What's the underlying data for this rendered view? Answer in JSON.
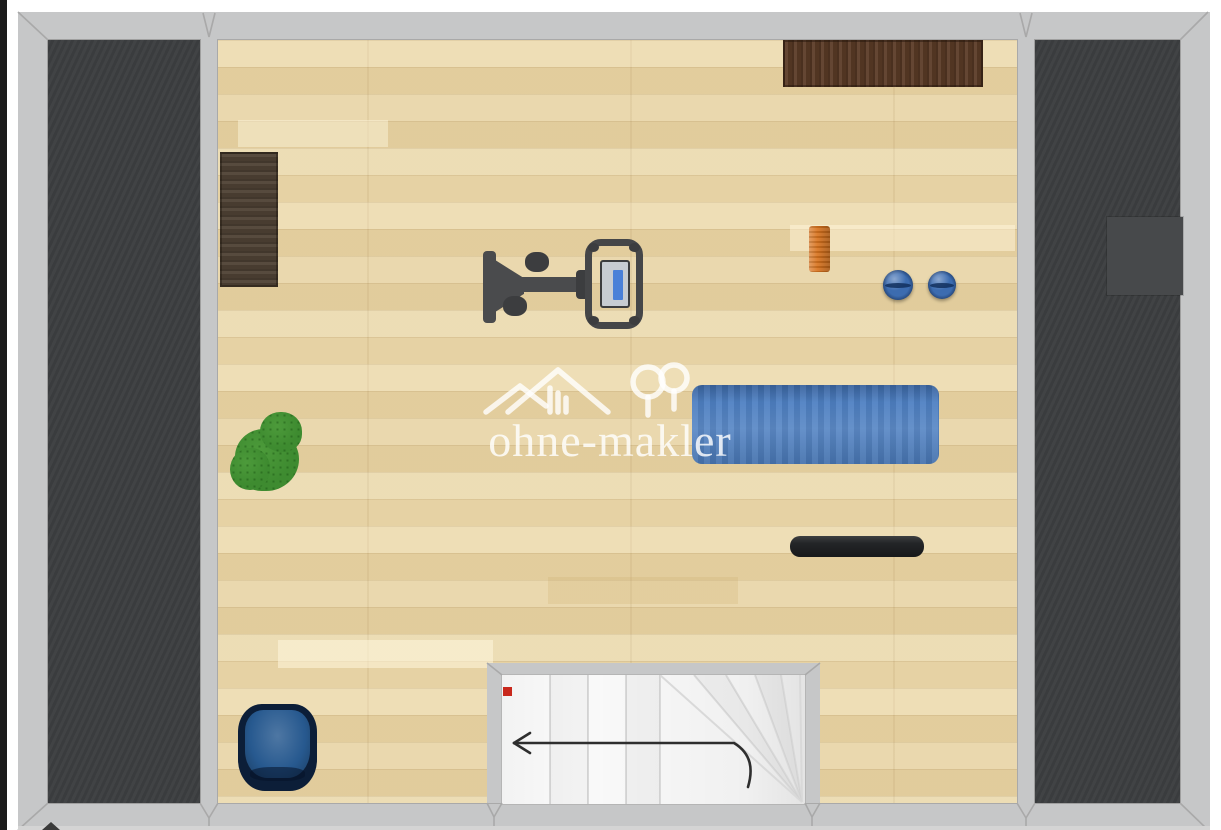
{
  "scene": {
    "type": "floor-plan-top-view",
    "description": "Attic fitness room floor plan with staircase, exercise equipment and side storage areas",
    "floor_material": "light oak parquet"
  },
  "watermark": {
    "text": "ohne-makler",
    "logo": "house-and-trees-icon",
    "color": "rgba(255,255,255,0.82)"
  },
  "palette": {
    "page_edge": "#1b1b1b",
    "wall": "#c6c7c8",
    "wall_seam": "#a9a9a9",
    "dark_area": "#3d3f41",
    "skylight": "#47494b",
    "floor_base": "#e8d6aa",
    "plank_light": "rgba(255,246,220,0.55)",
    "stair_bg": "#fafafa",
    "tread_line": "#d9d9d9",
    "arrow": "#2e2e2e",
    "red_marker": "#c8281c",
    "sideboard_brown": "#5a3b26",
    "desk_brown": "#4e4134",
    "equipment_gray": "#4a4b4d",
    "equipment_dark": "#3c3d3f",
    "console_body": "#c7ccd2",
    "console_screen": "#4a80d8",
    "roller_orange": "#d8731e",
    "ball_blue": "#3c6cb0",
    "mat_blue": "#4e80c2",
    "bar_black": "#232527",
    "plant_green": "#3e8b30",
    "chair_outer": "#0c1e38",
    "chair_inner": "#27598f"
  },
  "objects": [
    {
      "name": "sideboard-top-wall",
      "color": "#5a3b26"
    },
    {
      "name": "desk-left-wall",
      "color": "#4e4134"
    },
    {
      "name": "elliptical-trainer",
      "color": "#4a4b4d"
    },
    {
      "name": "foam-roller",
      "color": "#d8731e"
    },
    {
      "name": "medicine-ball-left",
      "color": "#3c6cb0"
    },
    {
      "name": "medicine-ball-right",
      "color": "#3c6cb0"
    },
    {
      "name": "yoga-mat",
      "color": "#4e80c2"
    },
    {
      "name": "weight-bar",
      "color": "#232527"
    },
    {
      "name": "plant",
      "color": "#3e8b30"
    },
    {
      "name": "armchair",
      "color": "#27598f"
    },
    {
      "name": "skylight",
      "color": "#47494b"
    },
    {
      "name": "staircase",
      "style": "straight-run-with-winders"
    }
  ],
  "staircase": {
    "arrow_direction": "left",
    "marker_color": "#c8281c",
    "tread_count_visible": 10
  }
}
